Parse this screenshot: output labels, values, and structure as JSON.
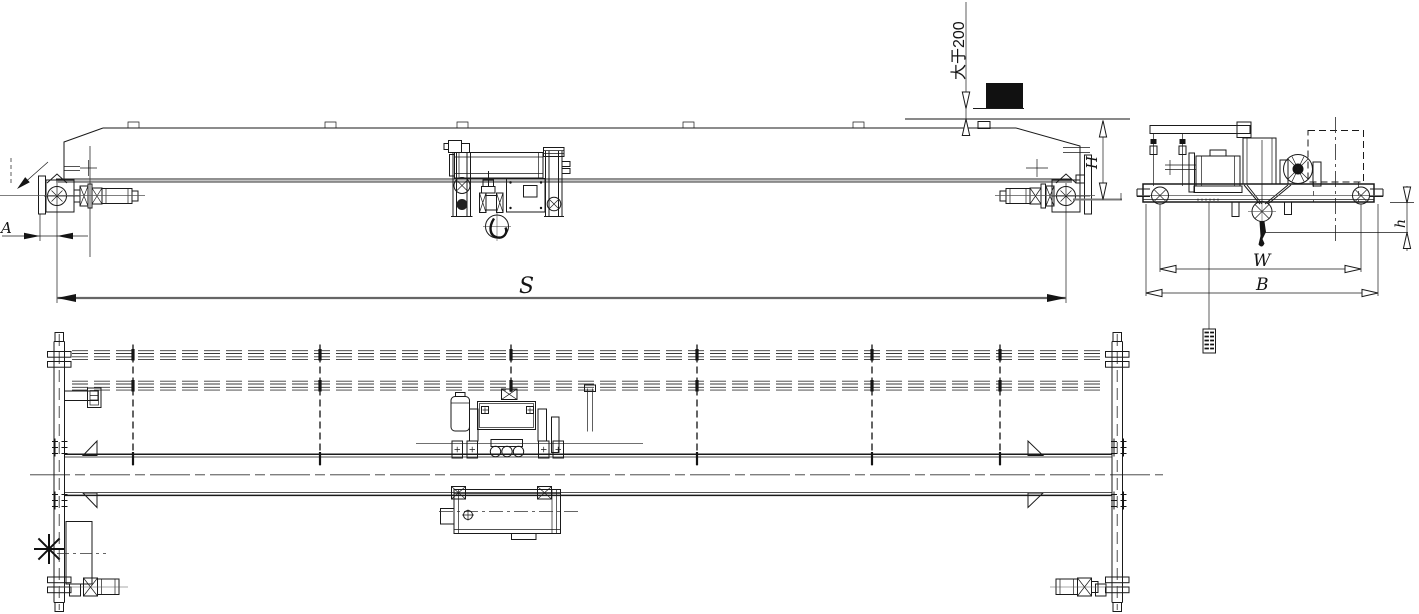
{
  "drawing": {
    "background": "#ffffff",
    "line_color": "#1a1a1a",
    "labels": {
      "span": "S",
      "end_approach": "A",
      "crane_height": "H",
      "hook_height": "h",
      "trolley_gauge": "W",
      "end_carriage_length": "B",
      "min_clearance": "大于200"
    }
  }
}
